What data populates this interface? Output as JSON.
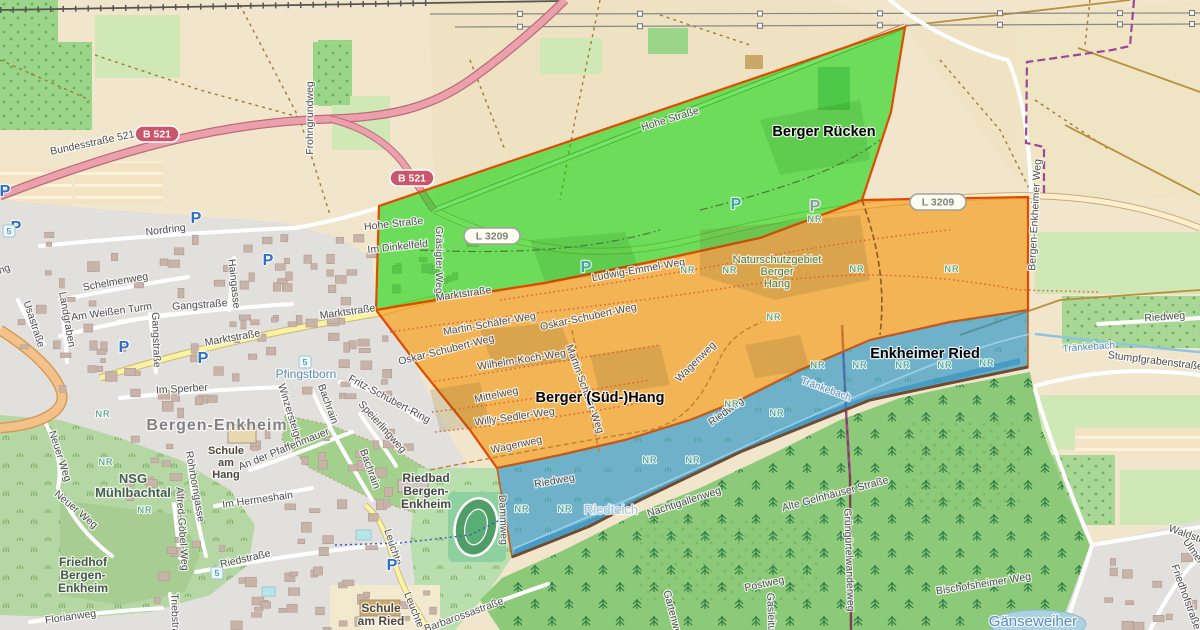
{
  "colors": {
    "zone_green": "#00d400",
    "zone_orange": "#f39206",
    "zone_blue": "#1e90c8",
    "border_red": "#e04b00",
    "boundary_purple": "#9b4896",
    "shield_b_bg": "#c9566b",
    "shield_l_bg": "#fdfdf2",
    "street_text": "#4d4d4d",
    "water_text": "#5d8cba",
    "nature_text": "#4c7a38",
    "nr_green": "#2e9478",
    "parking_blue": "#2a6fc9",
    "parking_teal": "#3aa7a0",
    "parking_gray": "#8a9aa0"
  },
  "zones": [
    {
      "id": "berger-ruecken",
      "name": "Berger Rücken",
      "x": 824,
      "y": 136
    },
    {
      "id": "berger-sued-hang",
      "name": "Berger (Süd-)Hang",
      "x": 600,
      "y": 402
    },
    {
      "id": "enkheimer-ried",
      "name": "Enkheimer Ried",
      "x": 925,
      "y": 358
    }
  ],
  "protected_area_label": {
    "lines": [
      "Naturschutzgebiet",
      "Berger",
      "Hang"
    ],
    "x": 777,
    "y": 263
  },
  "road_shields": [
    {
      "kind": "B",
      "text": "B 521",
      "x": 157,
      "y": 134
    },
    {
      "kind": "B",
      "text": "B 521",
      "x": 412,
      "y": 178
    },
    {
      "kind": "L",
      "text": "L 3209",
      "x": 492,
      "y": 236
    },
    {
      "kind": "L",
      "text": "L 3209",
      "x": 938,
      "y": 202
    }
  ],
  "street_labels": [
    {
      "t": "Bundesstraße 521",
      "x": 93,
      "y": 146,
      "r": -12
    },
    {
      "t": "Frohngrundweg",
      "x": 313,
      "y": 118,
      "r": -90
    },
    {
      "t": "Hohe Straße",
      "x": 671,
      "y": 122,
      "r": -17
    },
    {
      "t": "Hohe Straße",
      "x": 394,
      "y": 227,
      "r": -6
    },
    {
      "t": "Im Dinkelfeld",
      "x": 398,
      "y": 250,
      "r": -6
    },
    {
      "t": "Gräsigter Weg",
      "x": 436,
      "y": 260,
      "r": 90
    },
    {
      "t": "Marktstraße",
      "x": 464,
      "y": 297,
      "r": -8
    },
    {
      "t": "Marktstraße",
      "x": 233,
      "y": 341,
      "r": -10
    },
    {
      "t": "Marktstraße",
      "x": 348,
      "y": 315,
      "r": -8
    },
    {
      "t": "Nordring",
      "x": 166,
      "y": 233,
      "r": -7
    },
    {
      "t": "Nordring",
      "x": -8,
      "y": 277,
      "r": -20
    },
    {
      "t": "Schelmenweg",
      "x": 116,
      "y": 285,
      "r": -10
    },
    {
      "t": "Usastraße",
      "x": 31,
      "y": 325,
      "r": 72
    },
    {
      "t": "Landgraben",
      "x": 64,
      "y": 320,
      "r": 80
    },
    {
      "t": "Am Weißen Turm",
      "x": 112,
      "y": 315,
      "r": -8
    },
    {
      "t": "Gangstraße",
      "x": 200,
      "y": 308,
      "r": -4
    },
    {
      "t": "Gangstraße",
      "x": 153,
      "y": 340,
      "r": 88
    },
    {
      "t": "Haingasse",
      "x": 231,
      "y": 284,
      "r": 84
    },
    {
      "t": "Im Sperber",
      "x": 182,
      "y": 392,
      "r": -3
    },
    {
      "t": "Winzersteige",
      "x": 287,
      "y": 414,
      "r": 73
    },
    {
      "t": "Bachrain",
      "x": 325,
      "y": 405,
      "r": 70
    },
    {
      "t": "Bachrain",
      "x": 367,
      "y": 470,
      "r": 70
    },
    {
      "t": "Fritz-Schubert-Ring",
      "x": 388,
      "y": 402,
      "r": 28
    },
    {
      "t": "An der Pfaffenmauer",
      "x": 285,
      "y": 452,
      "r": -22
    },
    {
      "t": "Speierlingweg",
      "x": 380,
      "y": 429,
      "r": 48
    },
    {
      "t": "Neuer Weg",
      "x": 57,
      "y": 457,
      "r": 72
    },
    {
      "t": "Neuer Weg",
      "x": 74,
      "y": 512,
      "r": 40
    },
    {
      "t": "Im Hermeshain",
      "x": 258,
      "y": 503,
      "r": -8
    },
    {
      "t": "Röhrborngasse",
      "x": 192,
      "y": 487,
      "r": 80
    },
    {
      "t": "Alfred-Göbel-Weg",
      "x": 179,
      "y": 529,
      "r": 86
    },
    {
      "t": "Riedstraße",
      "x": 246,
      "y": 562,
      "r": -13
    },
    {
      "t": "Florianweg",
      "x": 71,
      "y": 620,
      "r": -8
    },
    {
      "t": "Triebstraße",
      "x": 172,
      "y": 620,
      "r": 88
    },
    {
      "t": "Leuchte",
      "x": 390,
      "y": 548,
      "r": 72
    },
    {
      "t": "Leuchte",
      "x": 411,
      "y": 611,
      "r": 68
    },
    {
      "t": "Barbarossastraße",
      "x": 465,
      "y": 618,
      "r": -20
    },
    {
      "t": "Dammweg",
      "x": 500,
      "y": 520,
      "r": 88
    },
    {
      "t": "Ludwig-Emmel-Weg",
      "x": 639,
      "y": 273,
      "r": -10
    },
    {
      "t": "Martin-Schäfer-Weg",
      "x": 490,
      "y": 327,
      "r": -10
    },
    {
      "t": "Oskar-Schubert-Weg",
      "x": 589,
      "y": 320,
      "r": -12
    },
    {
      "t": "Oskar-Schubert-Weg",
      "x": 447,
      "y": 353,
      "r": -14
    },
    {
      "t": "Wilhelm-Koch-Weg",
      "x": 522,
      "y": 363,
      "r": -9
    },
    {
      "t": "Martin-Schäfer-Weg",
      "x": 582,
      "y": 390,
      "r": 70
    },
    {
      "t": "Mittelweg",
      "x": 497,
      "y": 398,
      "r": -12
    },
    {
      "t": "Willy-Sedler-Weg",
      "x": 515,
      "y": 420,
      "r": -8
    },
    {
      "t": "Wagenweg",
      "x": 517,
      "y": 448,
      "r": -12
    },
    {
      "t": "Wagenweg",
      "x": 698,
      "y": 364,
      "r": -45
    },
    {
      "t": "Riedweg",
      "x": 555,
      "y": 484,
      "r": -10
    },
    {
      "t": "Riedweg",
      "x": 728,
      "y": 414,
      "r": -36
    },
    {
      "t": "Riedweg",
      "x": 1165,
      "y": 320,
      "r": -4
    },
    {
      "t": "Stumpfgrabenstraße",
      "x": 1155,
      "y": 364,
      "r": 7
    },
    {
      "t": "Nachtigallenweg",
      "x": 685,
      "y": 505,
      "r": -18
    },
    {
      "t": "Alte Gelnhäuser Straße",
      "x": 836,
      "y": 497,
      "r": -15
    },
    {
      "t": "Postweg",
      "x": 765,
      "y": 587,
      "r": -12
    },
    {
      "t": "Gasleitung",
      "x": 768,
      "y": 618,
      "r": 88
    },
    {
      "t": "Grüngürtelwanderweg",
      "x": 846,
      "y": 560,
      "r": 88
    },
    {
      "t": "Bischofsheimer Weg",
      "x": 984,
      "y": 587,
      "r": -9
    },
    {
      "t": "Gartenweg",
      "x": 670,
      "y": 616,
      "r": 75
    },
    {
      "t": "Friedhofstraße",
      "x": 1183,
      "y": 598,
      "r": 70
    },
    {
      "t": "Waldstraße",
      "x": 1193,
      "y": 540,
      "r": 20
    },
    {
      "t": "Ulmenweg",
      "x": 1197,
      "y": 562,
      "r": 55
    },
    {
      "t": "Bergen-Enkheimer Weg",
      "x": 1038,
      "y": 215,
      "r": -87
    }
  ],
  "water_labels": [
    {
      "t": "Pfingstborn",
      "x": 306,
      "y": 378,
      "s": 12
    },
    {
      "t": "Tränkebach",
      "x": 825,
      "y": 392,
      "r": 20,
      "s": 10
    },
    {
      "t": "Tränkebach",
      "x": 1089,
      "y": 350,
      "r": -4,
      "s": 10
    },
    {
      "t": "Riedteich",
      "x": 611,
      "y": 514,
      "s": 13,
      "light": true
    },
    {
      "t": "Gänseweiher",
      "x": 1033,
      "y": 626,
      "s": 15
    }
  ],
  "place_labels": [
    {
      "lines": [
        "Bergen-Enkheim"
      ],
      "x": 217,
      "y": 430,
      "s": 16,
      "c": "#828282",
      "ls": 1
    },
    {
      "lines": [
        "NSG",
        "Mühlbachtal"
      ],
      "x": 133,
      "y": 483,
      "s": 13,
      "c": "#44614f"
    },
    {
      "lines": [
        "Schule",
        "am",
        "Hang"
      ],
      "x": 226,
      "y": 454,
      "s": 11,
      "c": "#50483c"
    },
    {
      "lines": [
        "Friedhof",
        "Bergen-",
        "Enkheim"
      ],
      "x": 83,
      "y": 566,
      "s": 12,
      "c": "#46584a"
    },
    {
      "lines": [
        "Schule",
        "am Ried"
      ],
      "x": 381,
      "y": 612,
      "s": 12,
      "c": "#50483c"
    },
    {
      "lines": [
        "Riedbad",
        "Bergen-",
        "Enkheim"
      ],
      "x": 426,
      "y": 482,
      "s": 12,
      "c": "#474747"
    }
  ],
  "nr_label": "NR",
  "nr_markers": [
    {
      "x": 688,
      "y": 273
    },
    {
      "x": 730,
      "y": 273
    },
    {
      "x": 815,
      "y": 222
    },
    {
      "x": 857,
      "y": 272
    },
    {
      "x": 952,
      "y": 272
    },
    {
      "x": 774,
      "y": 320
    },
    {
      "x": 732,
      "y": 407
    },
    {
      "x": 777,
      "y": 416
    },
    {
      "x": 818,
      "y": 368
    },
    {
      "x": 860,
      "y": 368
    },
    {
      "x": 903,
      "y": 368
    },
    {
      "x": 945,
      "y": 368
    },
    {
      "x": 987,
      "y": 366
    },
    {
      "x": 650,
      "y": 463
    },
    {
      "x": 693,
      "y": 463
    },
    {
      "x": 522,
      "y": 512
    },
    {
      "x": 565,
      "y": 512
    },
    {
      "x": 103,
      "y": 417
    },
    {
      "x": 106,
      "y": 465
    },
    {
      "x": 145,
      "y": 513
    }
  ],
  "route_badges": [
    {
      "t": "5",
      "x": 9,
      "y": 231
    },
    {
      "t": "5",
      "x": 305,
      "y": 362
    },
    {
      "t": "5",
      "x": 217,
      "y": 573
    }
  ],
  "parking_label": "P",
  "parking_icons": [
    {
      "x": 5,
      "y": 196,
      "c": "blue"
    },
    {
      "x": 16,
      "y": 232,
      "c": "blue"
    },
    {
      "x": 196,
      "y": 223,
      "c": "blue"
    },
    {
      "x": 268,
      "y": 265,
      "c": "blue"
    },
    {
      "x": 124,
      "y": 352,
      "c": "blue"
    },
    {
      "x": 203,
      "y": 363,
      "c": "blue"
    },
    {
      "x": 392,
      "y": 570,
      "c": "blue"
    },
    {
      "x": 586,
      "y": 272,
      "c": "teal"
    },
    {
      "x": 736,
      "y": 209,
      "c": "teal"
    },
    {
      "x": 815,
      "y": 211,
      "c": "gray"
    }
  ]
}
